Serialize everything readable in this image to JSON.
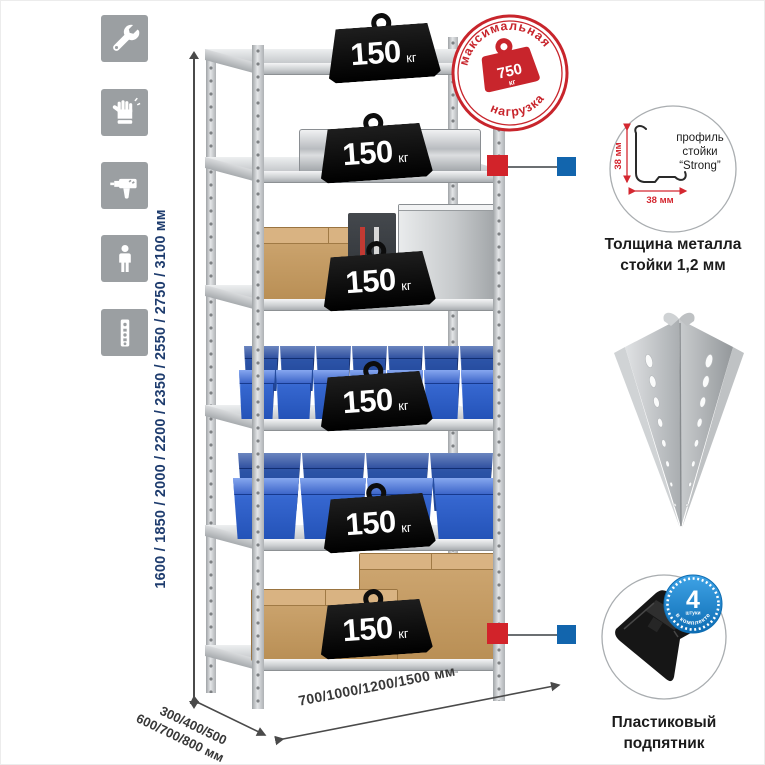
{
  "colors": {
    "accent_red": "#c8252c",
    "dimension_blue": "#1e3c6e",
    "bin_blue": "#2e5fc4",
    "badge_black": "#0f0f0f",
    "metal_gray": "#c6c9cc",
    "qty_badge_blue": "#1485d3"
  },
  "tool_icons": [
    {
      "name": "wrench"
    },
    {
      "name": "gloves"
    },
    {
      "name": "drill"
    },
    {
      "name": "person"
    },
    {
      "name": "perforated-post"
    }
  ],
  "height_dimension": {
    "label": "1600 / 1850 / 2000 / 2200 / 2350 / 2550 / 2750 / 3100 мм"
  },
  "max_load_stamp": {
    "arc_top": "максимальная",
    "arc_bottom": "нагрузка",
    "value": "750",
    "unit": "кг"
  },
  "load_badges": [
    {
      "value": "150",
      "unit": "кг"
    },
    {
      "value": "150",
      "unit": "кг"
    },
    {
      "value": "150",
      "unit": "кг"
    },
    {
      "value": "150",
      "unit": "кг"
    },
    {
      "value": "150",
      "unit": "кг"
    },
    {
      "value": "150",
      "unit": "кг"
    }
  ],
  "profile_callout": {
    "line1": "профиль",
    "line2": "стойки",
    "line3": "“Strong”",
    "vertical_dim": "38 мм",
    "horizontal_dim": "38 мм",
    "caption_line1": "Толщина металла",
    "caption_line2": "стойки 1,2 мм"
  },
  "quantity_badge": {
    "number": "4",
    "small_text": "штуки",
    "arc_text": "в комплекте"
  },
  "foot_callout": {
    "caption_line1": "Пластиковый",
    "caption_line2": "подпятник"
  },
  "bottom_dimensions": {
    "depth_line1": "300/400/500",
    "depth_line2": "600/700/800 мм",
    "width_label": "700/1000/1200/1500 мм"
  },
  "rack": {
    "shelf_count": 6,
    "small_bins_per_row": 7,
    "large_bins_per_row": 4,
    "bin_rows": 2
  }
}
